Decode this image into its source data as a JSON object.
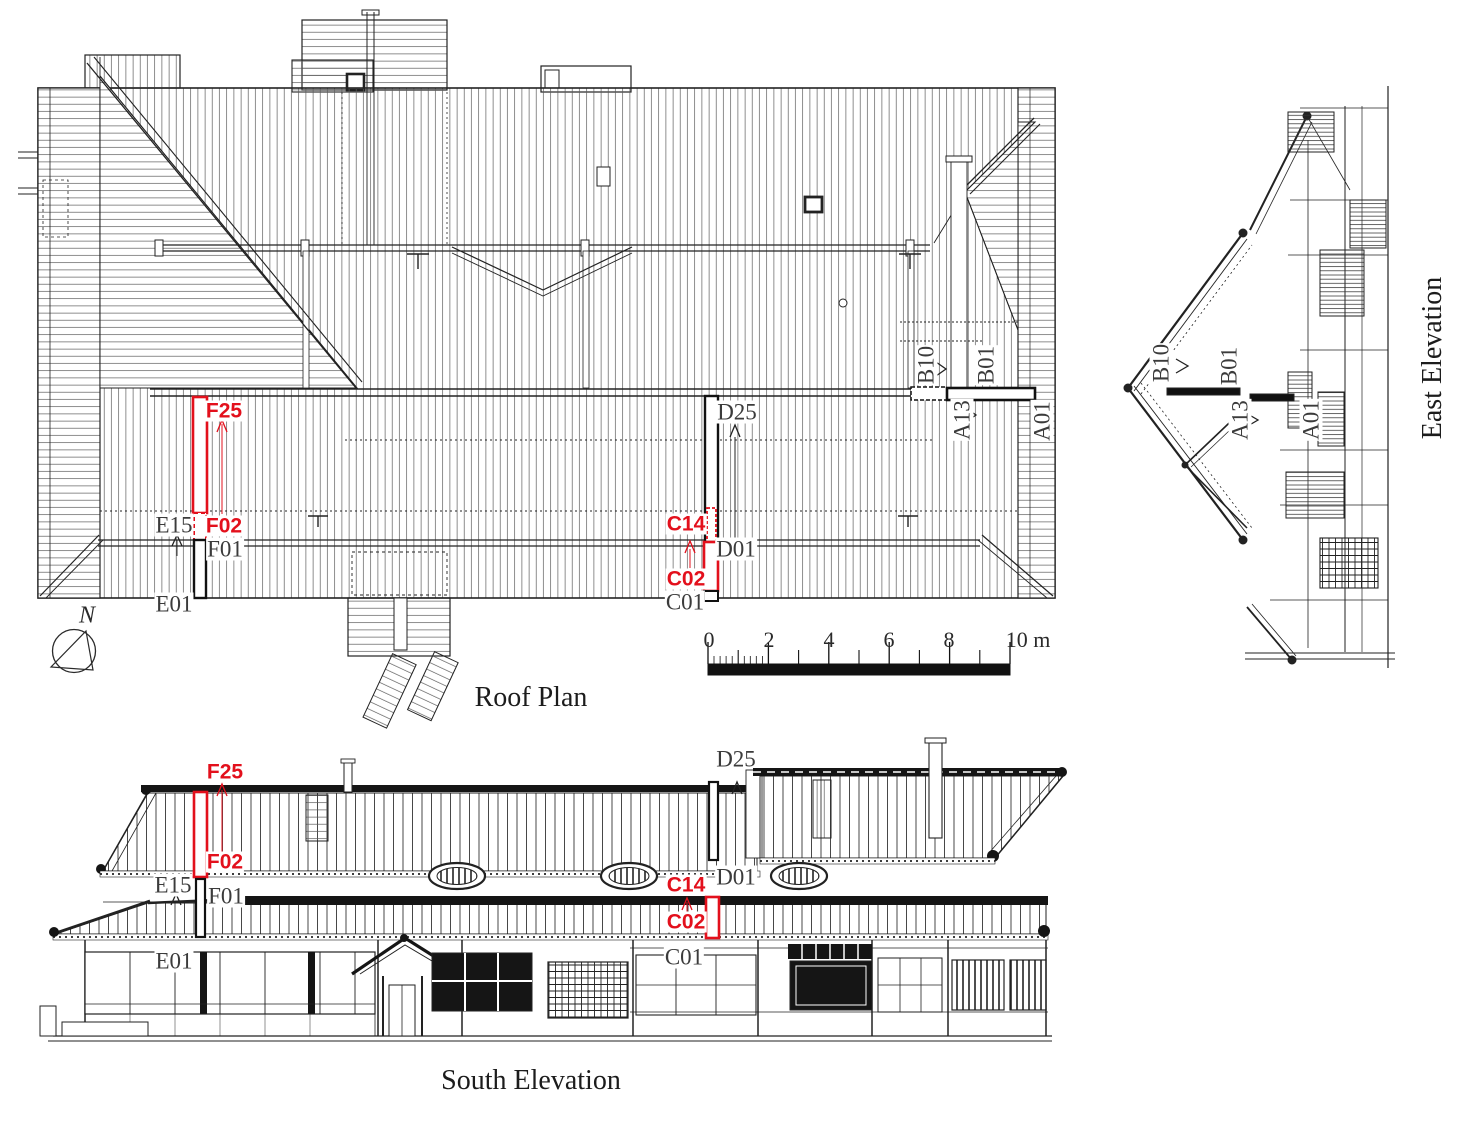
{
  "colors": {
    "ink": "#222222",
    "label_ink": "#3b3b3b",
    "accent_red": "#e3101c",
    "background": "#ffffff"
  },
  "roof_plan": {
    "title": "Roof Plan",
    "north_label": "N",
    "scale": {
      "t0": "0",
      "t2": "2",
      "t4": "4",
      "t6": "6",
      "t8": "8",
      "t10": "10 m"
    },
    "labels": {
      "f25": "F25",
      "e15": "E15",
      "f02": "F02",
      "f01": "F01",
      "e01": "E01",
      "d25": "D25",
      "c14": "C14",
      "d01": "D01",
      "c02": "C02",
      "c01": "C01",
      "b10": "B10",
      "b01": "B01",
      "a13": "A13",
      "a01": "A01"
    }
  },
  "east_elevation": {
    "title": "East Elevation",
    "labels": {
      "b10": "B10",
      "b01": "B01",
      "a13": "A13",
      "a01": "A01"
    }
  },
  "south_elevation": {
    "title": "South Elevation",
    "labels": {
      "f25": "F25",
      "f02": "F02",
      "e15": "E15",
      "f01": "F01",
      "e01": "E01",
      "d25": "D25",
      "d01": "D01",
      "c14": "C14",
      "c02": "C02",
      "c01": "C01"
    }
  }
}
